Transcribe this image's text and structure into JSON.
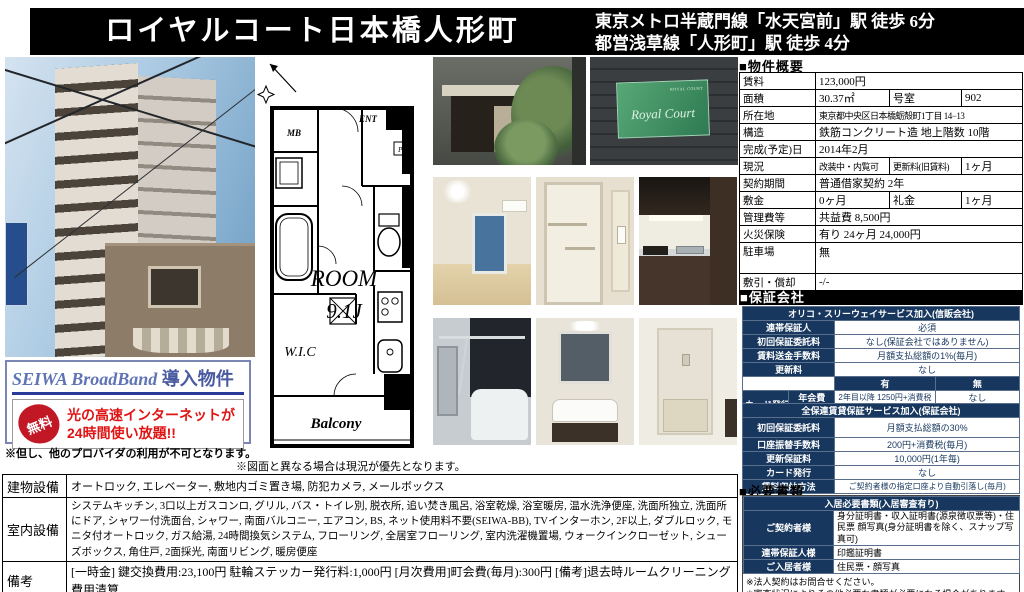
{
  "header": {
    "title": "ロイヤルコート日本橋人形町",
    "access_line1": "東京メトロ半蔵門線「水天宮前」駅 徒歩 6分",
    "access_line2": "都営浅草線「人形町」駅 徒歩 4分"
  },
  "photos": {
    "nameplate_script": "Royal Court",
    "nameplate_caption": "ROYAL COURT"
  },
  "floorplan": {
    "labels": {
      "mb": "MB",
      "ent": "ENT",
      "ps": "PS",
      "wic": "W.I.C",
      "room_line1": "ROOM",
      "room_line2": "9.1J",
      "balcony": "Balcony"
    },
    "note": "※図面と異なる場合は現況が優先となります。"
  },
  "broadband": {
    "title_en": "SEIWA BroadBand",
    "title_ja": " 導入物件",
    "stamp": "無料",
    "message_line1": "光の高速インターネットが",
    "message_line2": "24時間使い放題!!",
    "note": "※但し、他のプロバイダの利用が不可となります。"
  },
  "overview": {
    "section_title": "■物件概要",
    "rent_label": "賃料",
    "rent_value": "123,000円",
    "area_label": "面積",
    "area_value": "30.37㎡",
    "unit_label": "号室",
    "unit_value": "902",
    "address_label": "所在地",
    "address_value": "東京都中央区日本橋蛎殻町1丁目 14−13",
    "structure_label": "構造",
    "structure_value": "鉄筋コンクリート造 地上階数 10階",
    "completion_label": "完成(予定)日",
    "completion_value": "2014年2月",
    "status_label": "現況",
    "status_value": "改装中・内覧可",
    "renewal_label": "更新料(旧賃料)",
    "renewal_value": "1ヶ月",
    "contract_label": "契約期間",
    "contract_value": "普通借家契約 2年",
    "deposit_label": "敷金",
    "deposit_value": "0ヶ月",
    "key_money_label": "礼金",
    "key_money_value": "1ヶ月",
    "mgmt_label": "管理費等",
    "mgmt_value": "共益費 8,500円",
    "insurance_label": "火災保険",
    "insurance_value": "有り 24ヶ月 24,000円",
    "parking_label": "駐車場",
    "parking_value": "無",
    "amort_label": "敷引・償却",
    "amort_value": "-/-"
  },
  "guarantee": {
    "section_title": "■保証会社",
    "orico": {
      "title": "オリコ・スリーウェイサービス加入(信販会社)",
      "guarantor_label": "連帯保証人",
      "guarantor_value": "必須",
      "initial_fee_label": "初回保証委託料",
      "initial_fee_value": "なし(保証会社ではありません)",
      "remittance_label": "賃料送金手数料",
      "remittance_value": "月額支払総額の1%(毎月)",
      "renewal_label": "更新料",
      "renewal_value": "なし",
      "col_with": "有",
      "col_without": "無",
      "card_label": "カード発行",
      "annual_label": "年会費",
      "annual_with": "2年目以降 1250円+消費税",
      "annual_without": "なし",
      "point_label": "ポイント",
      "point_with": "1000円につき1スマイル",
      "point_without": "なし",
      "collection_label": "賃料収納方法",
      "collection_value": "ご契約者様の指定口座より自動引落し(毎月)"
    },
    "zenhoren": {
      "title": "全保連賃貸保証サービス加入(保証会社)",
      "initial_fee_label": "初回保証委託料",
      "initial_fee_value": "月額支払総額の30%",
      "transfer_label": "口座振替手数料",
      "transfer_value": "200円+消費税(毎月)",
      "renewal_label": "更新保証料",
      "renewal_value": "10,000円(1年毎)",
      "card_label": "カード発行",
      "card_value": "なし",
      "collection_label": "賃料収納方法",
      "collection_value": "ご契約者様の指定口座より自動引落し(毎月)"
    }
  },
  "documents": {
    "section_title": "■必要書類",
    "table_title": "入居必要書類(入居審査有り)",
    "contractor_label": "ご契約者様",
    "contractor_value": "身分証明書・収入証明書(源泉徴収票等)・住民票 顔写真(身分証明書を除く、スナップ写真可)",
    "guarantor_label": "連帯保証人様",
    "guarantor_value": "印鑑証明書",
    "resident_label": "ご入居者様",
    "resident_value": "住民票・顔写真",
    "note1": "※法人契約はお問合せください。",
    "note2": "※審査状況によりその他必要な書類が必要になる場合があります。"
  },
  "facilities": {
    "building_label": "建物設備",
    "building_value": "オートロック, エレベーター, 敷地内ゴミ置き場, 防犯カメラ, メールボックス",
    "room_label": "室内設備",
    "room_value": "システムキッチン, 3口以上ガスコンロ, グリル, バス・トイレ別, 脱衣所, 追い焚き風呂, 浴室乾燥, 浴室暖房, 温水洗浄便座, 洗面所独立, 洗面所にドア, シャワー付洗面台, シャワー, 南面バルコニー, エアコン, BS, ネット使用料不要(SEIWA-BB), TVインターホン, 2F以上, ダブルロック, モニタ付オートロック, ガス給湯, 24時間換気システム, フローリング, 全居室フローリング, 室内洗濯機置場, ウォークインクローゼット, シューズボックス, 角住戸, 2面採光, 南面リビング, 暖房便座",
    "remarks_label": "備考",
    "remarks_value": "[一時金] 鍵交換費用:23,100円 駐輪ステッカー発行料:1,000円 [月次費用]町会費(毎月):300円 [備考]退去時ルームクリーニング費用清算"
  },
  "colors": {
    "accent_navy": "#17375e",
    "stamp_red": "#c21826",
    "message_red": "#e01414"
  }
}
